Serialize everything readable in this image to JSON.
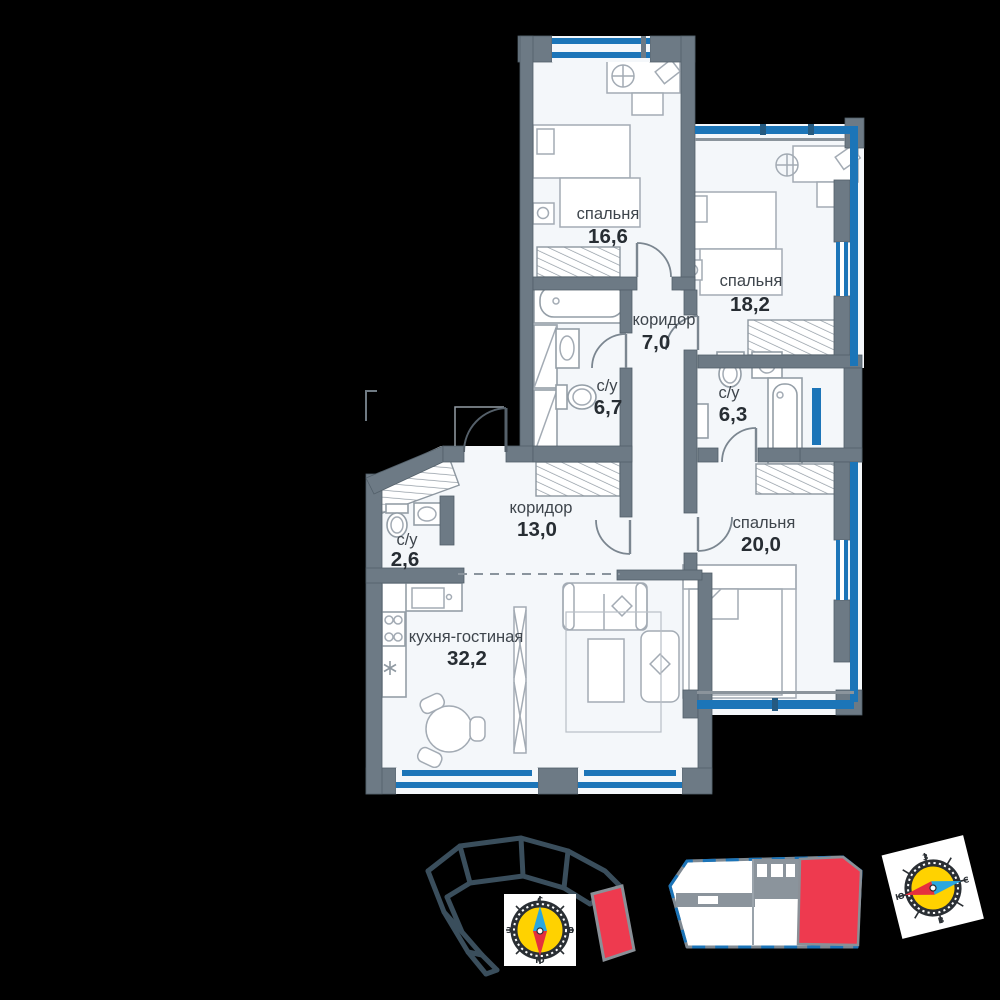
{
  "plan": {
    "rooms": [
      {
        "id": "bedroom-1",
        "name": "спальня",
        "area": "16,6"
      },
      {
        "id": "bedroom-2",
        "name": "спальня",
        "area": "18,2"
      },
      {
        "id": "corridor-1",
        "name": "коридор",
        "area": "7,0"
      },
      {
        "id": "bathroom-1",
        "name": "с/у",
        "area": "6,7"
      },
      {
        "id": "bathroom-2",
        "name": "с/у",
        "area": "6,3"
      },
      {
        "id": "bedroom-3",
        "name": "спальня",
        "area": "20,0"
      },
      {
        "id": "corridor-2",
        "name": "коридор",
        "area": "13,0"
      },
      {
        "id": "bathroom-3",
        "name": "с/у",
        "area": "2,6"
      },
      {
        "id": "kitchen-living",
        "name": "кухня-гостиная",
        "area": "32,2"
      }
    ]
  },
  "compass": {
    "north": "С",
    "south": "Ю",
    "west": "З",
    "east": "В"
  },
  "colors": {
    "background": "#000000",
    "walls": "#6d7a85",
    "windows": "#1c75b8",
    "room_fill": "#f4f7fa",
    "highlight": "#ee3a4f",
    "compass_face": "#ffd200",
    "footprint_outline": "#3a4e5c"
  }
}
